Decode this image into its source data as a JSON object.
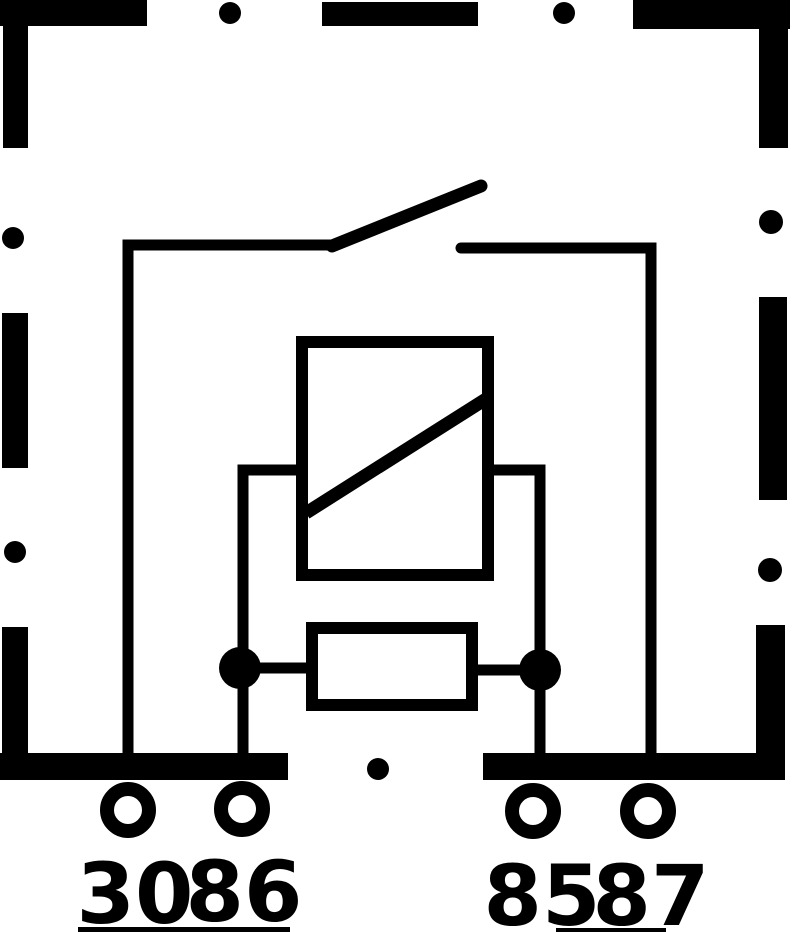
{
  "page": {
    "background": "#ffffff",
    "ink": "#000000"
  },
  "diagram": {
    "kind": "automotive-relay-circuit-schematic",
    "housing": "dashed-rectangular-relay-housing",
    "components": {
      "switch": "normally-open-contact",
      "coil": "relay-coil-box-with-diagonal",
      "resistor": "parallel-resistor"
    },
    "terminals": [
      {
        "label": "30"
      },
      {
        "label": "86"
      },
      {
        "label": "85"
      },
      {
        "label": "87"
      }
    ]
  }
}
